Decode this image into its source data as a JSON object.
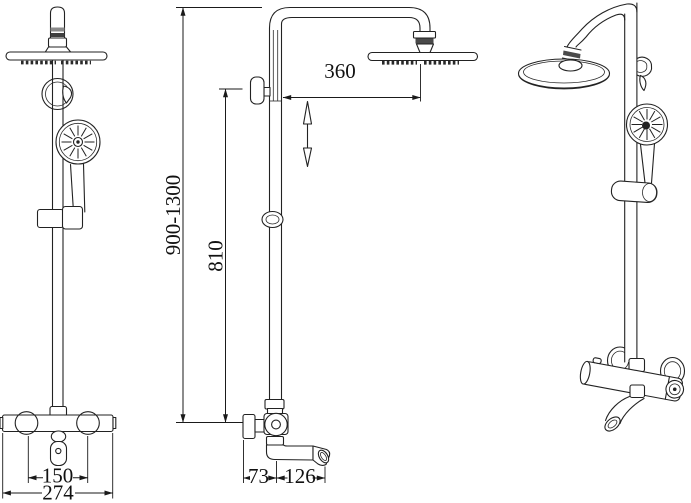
{
  "drawing": {
    "dimensions": {
      "arm_reach": "360",
      "height_range": "900-1300",
      "bar_height": "810",
      "inlet_centers": "150",
      "valve_width": "274",
      "wall_depth": "73",
      "spout_reach": "126"
    },
    "colors": {
      "line": "#222222",
      "background": "#ffffff",
      "band_dark": "#3f3f3f",
      "band_light": "#8a8a8a"
    }
  }
}
